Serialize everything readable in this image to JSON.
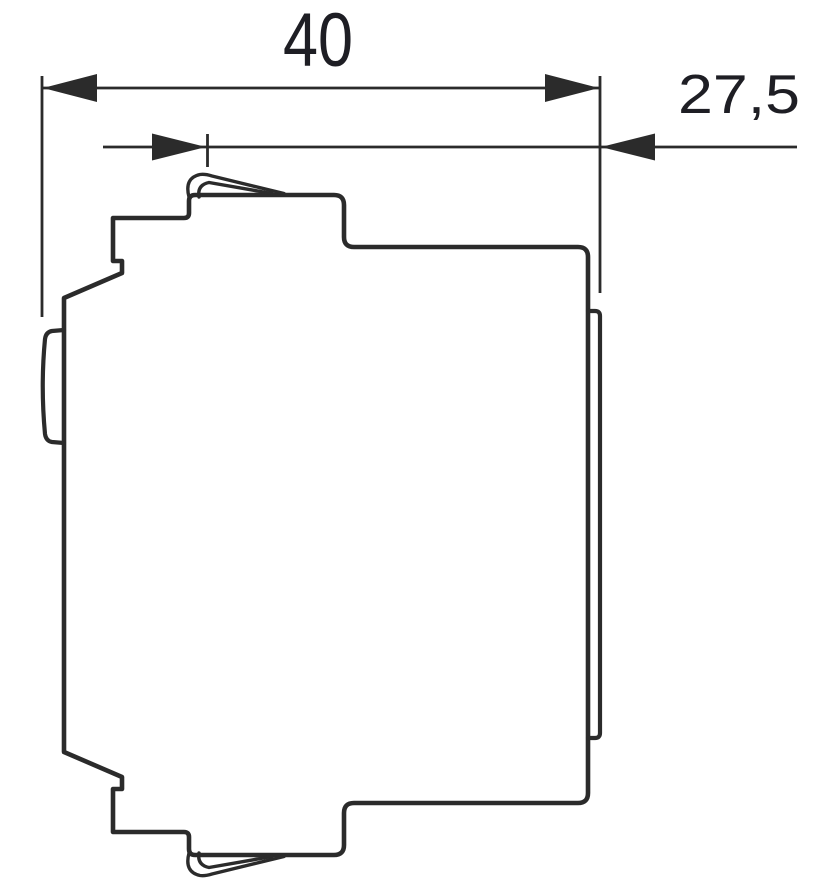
{
  "drawing": {
    "dimensions": {
      "width": {
        "label": "40"
      },
      "depth": {
        "label": "27,5"
      }
    },
    "colors": {
      "line": "#2b2b2b",
      "text": "#1e1e24",
      "background": "#ffffff"
    }
  }
}
